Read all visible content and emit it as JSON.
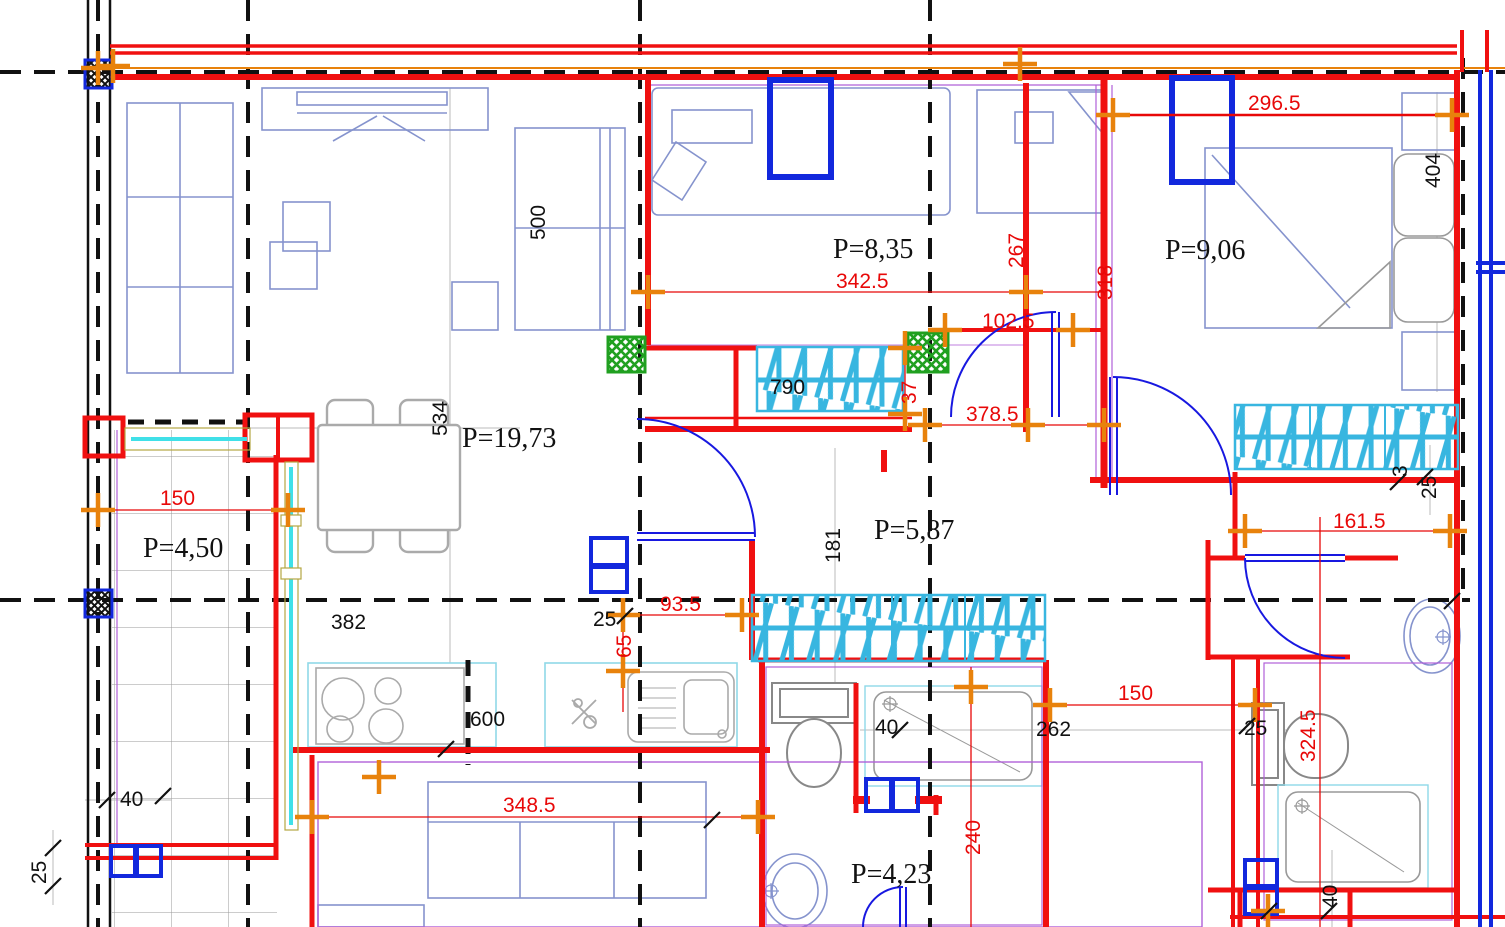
{
  "drawing_type": "architectural-floor-plan",
  "rooms": [
    {
      "id": "living-dining",
      "v": "P=19,73"
    },
    {
      "id": "balcony",
      "v": "P=4,50"
    },
    {
      "id": "bedroom-middle",
      "v": "P=8,35"
    },
    {
      "id": "bedroom-right",
      "v": "P=9,06"
    },
    {
      "id": "hall",
      "v": "P=5,87"
    },
    {
      "id": "bathroom",
      "v": "P=4,23"
    }
  ],
  "dims": [
    {
      "v": "296.5",
      "color": "red"
    },
    {
      "v": "342.5",
      "color": "red"
    },
    {
      "v": "102.5",
      "color": "red"
    },
    {
      "v": "378.5",
      "color": "red"
    },
    {
      "v": "267",
      "color": "red"
    },
    {
      "v": "318",
      "color": "red"
    },
    {
      "v": "37",
      "color": "red"
    },
    {
      "v": "161.5",
      "color": "red"
    },
    {
      "v": "150",
      "color": "red"
    },
    {
      "v": "150",
      "color": "red"
    },
    {
      "v": "93.5",
      "color": "red"
    },
    {
      "v": "65",
      "color": "red"
    },
    {
      "v": "348.5",
      "color": "red"
    },
    {
      "v": "324.5",
      "color": "red"
    },
    {
      "v": "240",
      "color": "red"
    },
    {
      "v": "500",
      "color": "black"
    },
    {
      "v": "534",
      "color": "black"
    },
    {
      "v": "404",
      "color": "black"
    },
    {
      "v": "382",
      "color": "black"
    },
    {
      "v": "600",
      "color": "black"
    },
    {
      "v": "790",
      "color": "black"
    },
    {
      "v": "181",
      "color": "black"
    },
    {
      "v": "262",
      "color": "black"
    },
    {
      "v": "40",
      "color": "black"
    },
    {
      "v": "40",
      "color": "black"
    },
    {
      "v": "40",
      "color": "black"
    },
    {
      "v": "25",
      "color": "black"
    },
    {
      "v": "25",
      "color": "black"
    },
    {
      "v": "25",
      "color": "black"
    },
    {
      "v": "25",
      "color": "black"
    },
    {
      "v": "3",
      "color": "black"
    }
  ],
  "colors": {
    "wall_red": "#f01010",
    "dim_red": "#e80808",
    "accent_orange": "#e8820c",
    "axis_black": "#111111",
    "door_blue": "#1818e0",
    "shaft_blue": "#1228dd",
    "furniture_blue": "#8593cd",
    "fixture_gray": "#909090",
    "radiator_cyan": "#38b6e0",
    "counter_cyan": "#8fd8e8",
    "shaft_green": "#20a020",
    "purple": "#b060d8"
  }
}
